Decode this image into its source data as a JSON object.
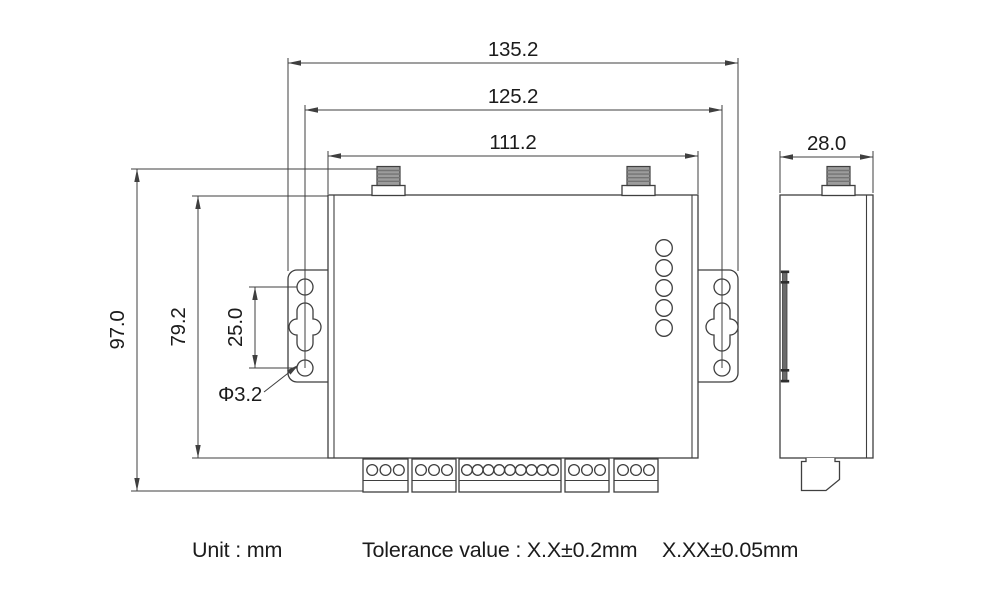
{
  "dimensions": {
    "overall_width": "135.2",
    "bracket_hole_span": "125.2",
    "body_width": "111.2",
    "depth": "28.0",
    "overall_height": "97.0",
    "body_height": "79.2",
    "bracket_hole_spacing": "25.0",
    "bracket_hole_diameter": "Φ3.2"
  },
  "footer": {
    "unit_label": "Unit : mm",
    "tolerance_label": "Tolerance value : X.X±0.2mm",
    "tolerance_label_2": "X.XX±0.05mm"
  },
  "device": {
    "led_count": 5,
    "terminal_blocks_pin_counts": [
      3,
      3,
      9,
      3,
      3
    ],
    "antenna_connectors_front": 2,
    "antenna_connectors_side": 1,
    "bracket_holes_per_side": 2
  },
  "colors": {
    "line": "#3f3f3f",
    "connector": "#9c9c9c",
    "connector_stripe": "#747474",
    "background": "#ffffff"
  }
}
